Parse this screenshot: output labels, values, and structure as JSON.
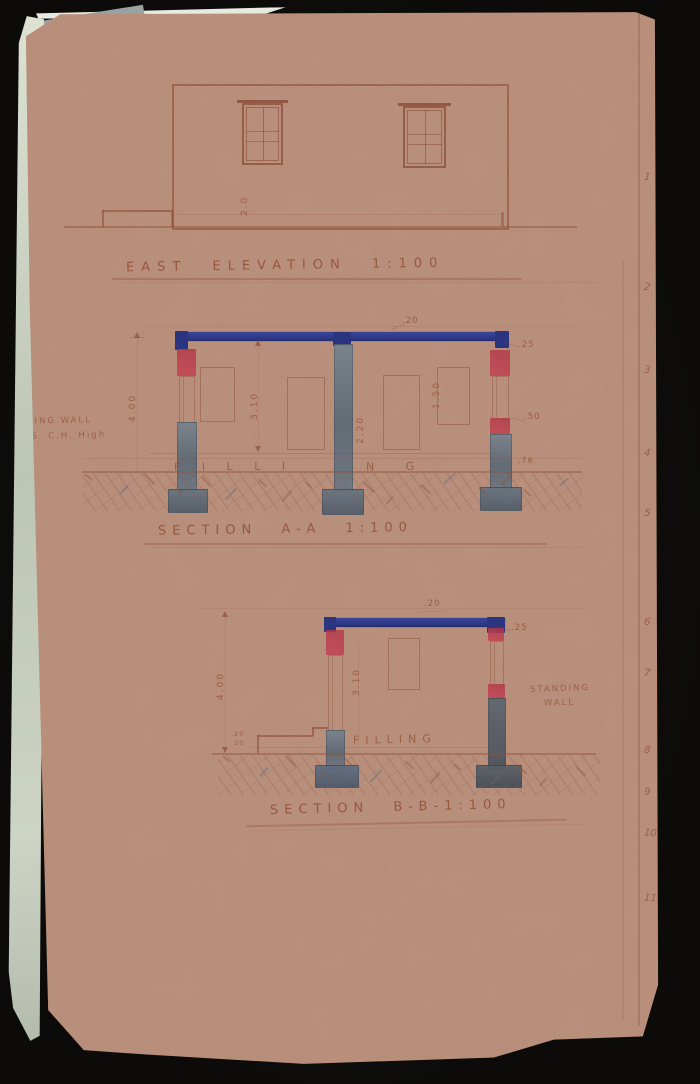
{
  "scan": {
    "background_color": "#0d0c0a",
    "paper_color": "#b98f7b",
    "page_edge_color": "#ccd3c4",
    "ink_color": "#96583f",
    "beam_blue": "#2f3a8d",
    "crayon_red": "#c4505c",
    "column_grey": "#687683"
  },
  "elevation": {
    "title": "EAST ELEVATION 1:100",
    "height_dim": "2.0"
  },
  "section_a": {
    "title": "SECTION A-A 1:100",
    "filling_left": "F I L L I",
    "filling_right": "N G",
    "dim_roof": ".20",
    "dim_beam": ".25",
    "dim_total_height": "4.00",
    "dim_clear_height": "3.10",
    "dim_door": "2.20",
    "dim_window": "1.50",
    "dim_block": ".50",
    "dim_floor": ".76",
    "margin_note_line1": "DING WALL",
    "margin_note_line2": "16· C.H. High"
  },
  "section_b": {
    "title": "SECTION B-B-1:100",
    "filling": "FILLING",
    "dim_roof": ".20",
    "dim_beam": ".25",
    "dim_total_height": "4.00",
    "dim_clear_height": "3.10",
    "dim_step_riser1": ".20",
    "dim_step_riser2": ".20",
    "note_line1": "STANDING",
    "note_line2": "WALL"
  },
  "margin_numbers": [
    "1",
    "2",
    "3",
    "4",
    "5",
    "6",
    "7",
    "8",
    "9",
    "10",
    "11"
  ]
}
